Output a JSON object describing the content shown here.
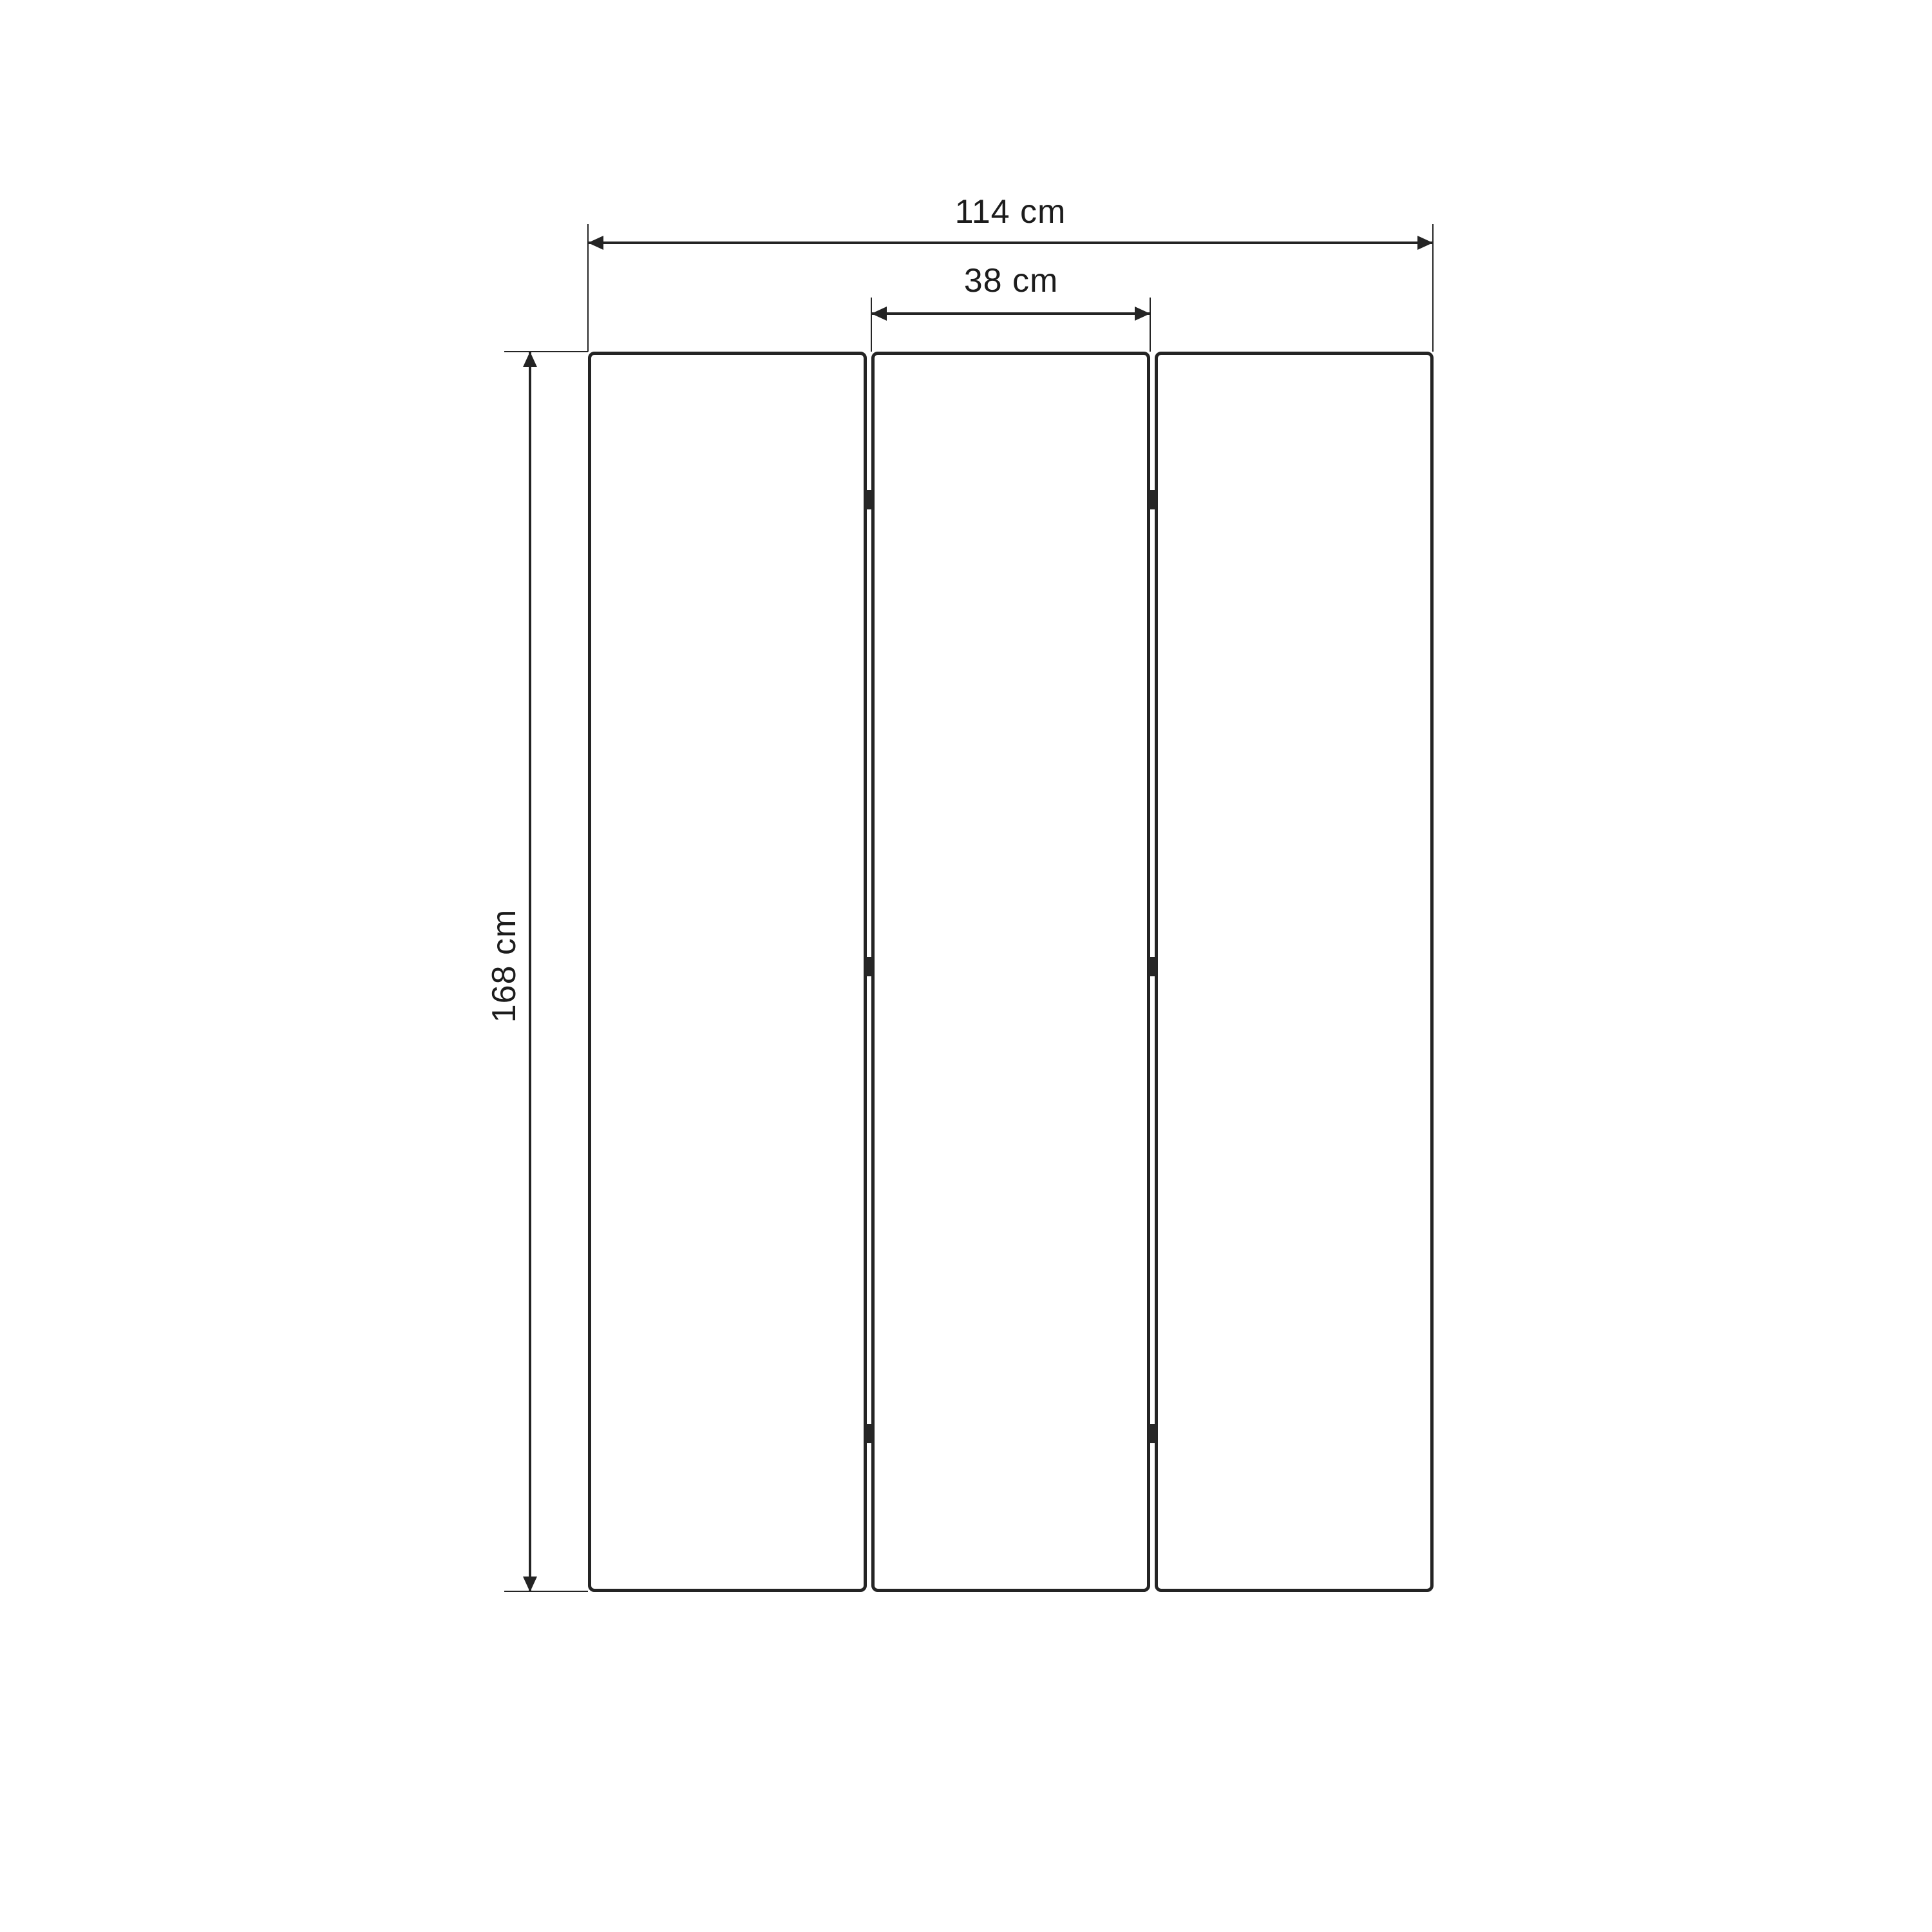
{
  "diagram": {
    "background_color": "#ffffff",
    "line_color": "#242424",
    "text_color": "#1c1c1c",
    "panel_count": 3,
    "hinge_count": 6,
    "dimensions": {
      "total_width": {
        "label": "114 cm",
        "value": 114,
        "unit": "cm"
      },
      "panel_width": {
        "label": "38 cm",
        "value": 38,
        "unit": "cm"
      },
      "height": {
        "label": "168 cm",
        "value": 168,
        "unit": "cm"
      }
    }
  }
}
